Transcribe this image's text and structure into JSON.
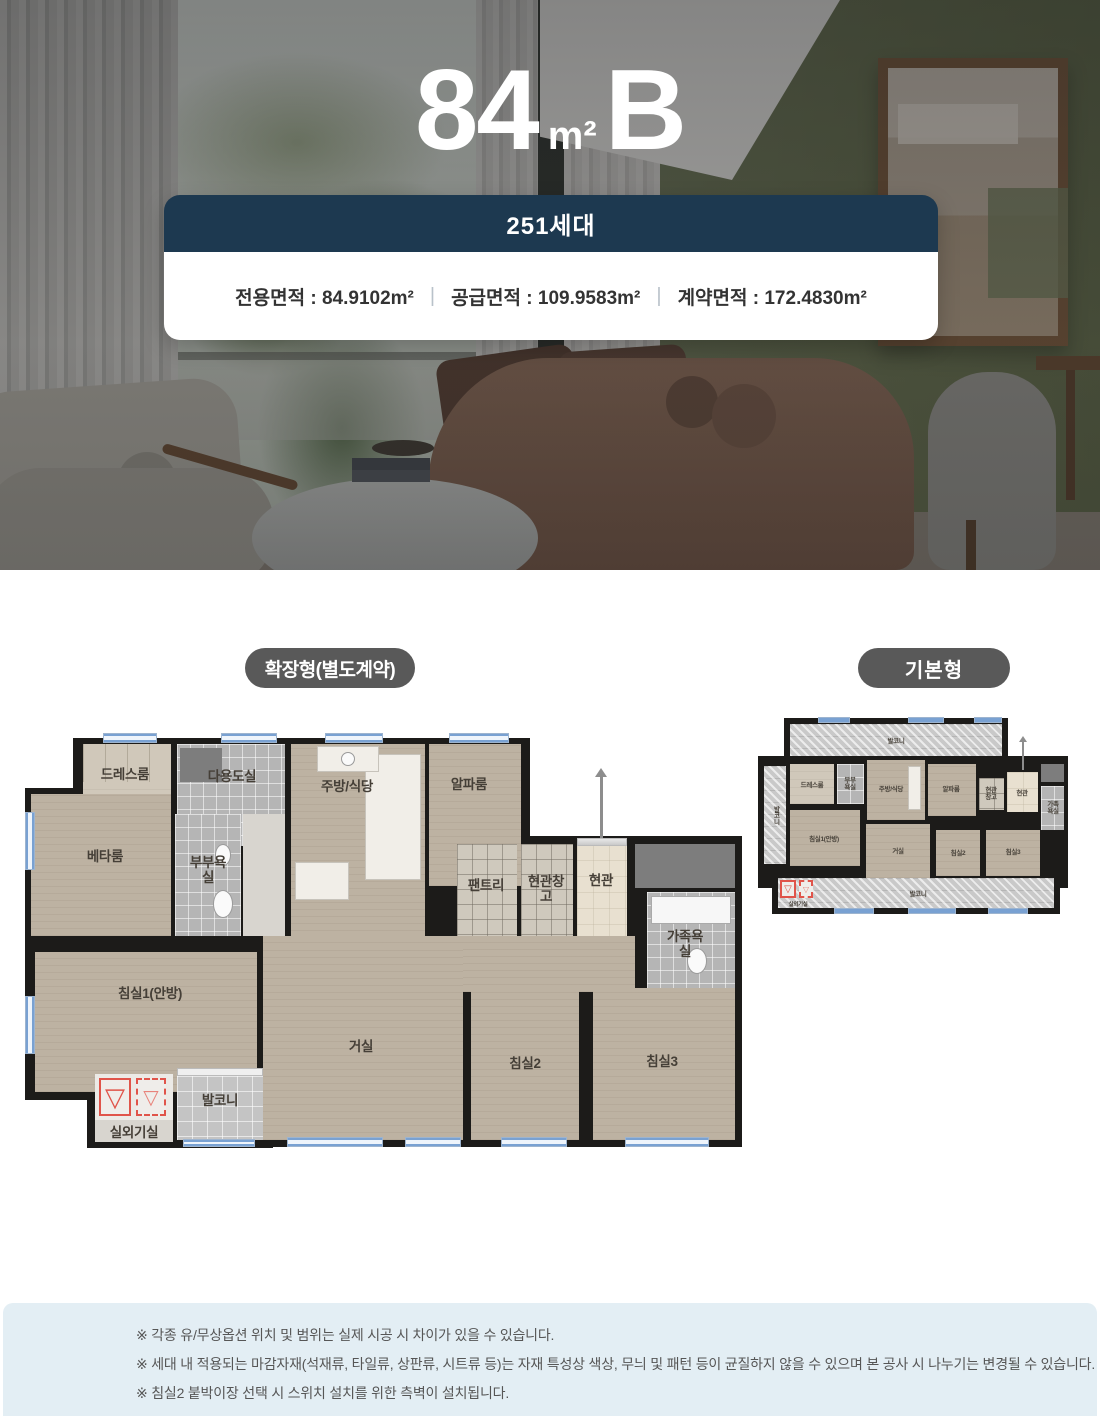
{
  "hero": {
    "title_num": "84",
    "title_unit": "m²",
    "title_letter": "B",
    "badge": "251세대",
    "area_private": "전용면적 : 84.9102m²",
    "area_supply": "공급면적 : 109.9583m²",
    "area_contract": "계약면적 : 172.4830m²",
    "divider": "|"
  },
  "plans": {
    "expanded_label": "확장형(별도계약)",
    "basic_label": "기본형"
  },
  "rooms": {
    "dress": "드레스룸",
    "utility": "다용도실",
    "kitchen": "주방/식당",
    "alpha": "알파룸",
    "beta": "베타룸",
    "mbath": "부부욕실",
    "pantry": "팬트리",
    "storage": "현관창고",
    "entrance": "현관",
    "fambath": "가족욕실",
    "bed1": "침실1(안방)",
    "living": "거실",
    "bed2": "침실2",
    "bed3": "침실3",
    "balcony": "발코니",
    "outdoor": "실외기실"
  },
  "symbols": {
    "ac_mark": "▽"
  },
  "colors": {
    "navy": "#1d3950",
    "pill_gray": "#595959",
    "note_bg": "#e3eef4",
    "plan_red": "#e0544a"
  },
  "notes": [
    "※ 각종 유/무상옵션 위치 및 범위는 실제 시공 시 차이가 있을 수 있습니다.",
    "※ 세대 내 적용되는 마감자재(석재류, 타일류, 상판류, 시트류 등)는 자재 특성상 색상, 무늬 및 패턴 등이 균질하지 않을 수 있으며 본 공사 시 나누기는 변경될 수 있습니다.",
    "※ 침실2 붙박이장 선택 시 스위치 설치를 위한 측벽이 설치됩니다."
  ]
}
